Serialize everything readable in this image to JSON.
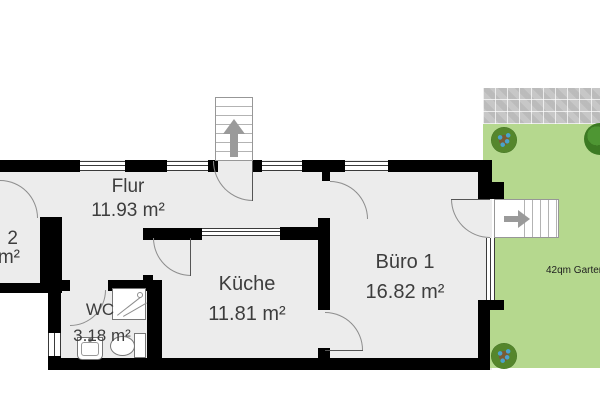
{
  "rooms": {
    "flur": {
      "name": "Flur",
      "area": "11.93 m²"
    },
    "kueche": {
      "name": "Küche",
      "area": "11.81 m²"
    },
    "buero1": {
      "name": "Büro 1",
      "area": "16.82 m²"
    },
    "wc": {
      "name": "WC",
      "area": "3.18 m²"
    },
    "cutoff": {
      "name": "2",
      "area": "m²"
    }
  },
  "garden": {
    "label": "42qm Garten"
  },
  "colors": {
    "floor": "#ececec",
    "wall": "#000000",
    "grass": "#b5d88e",
    "pavers": "#c7c7c7",
    "door_arc": "#8d8d8d",
    "stair_arrow": "#9a9a9a",
    "label_text": "#3d3d3d"
  }
}
